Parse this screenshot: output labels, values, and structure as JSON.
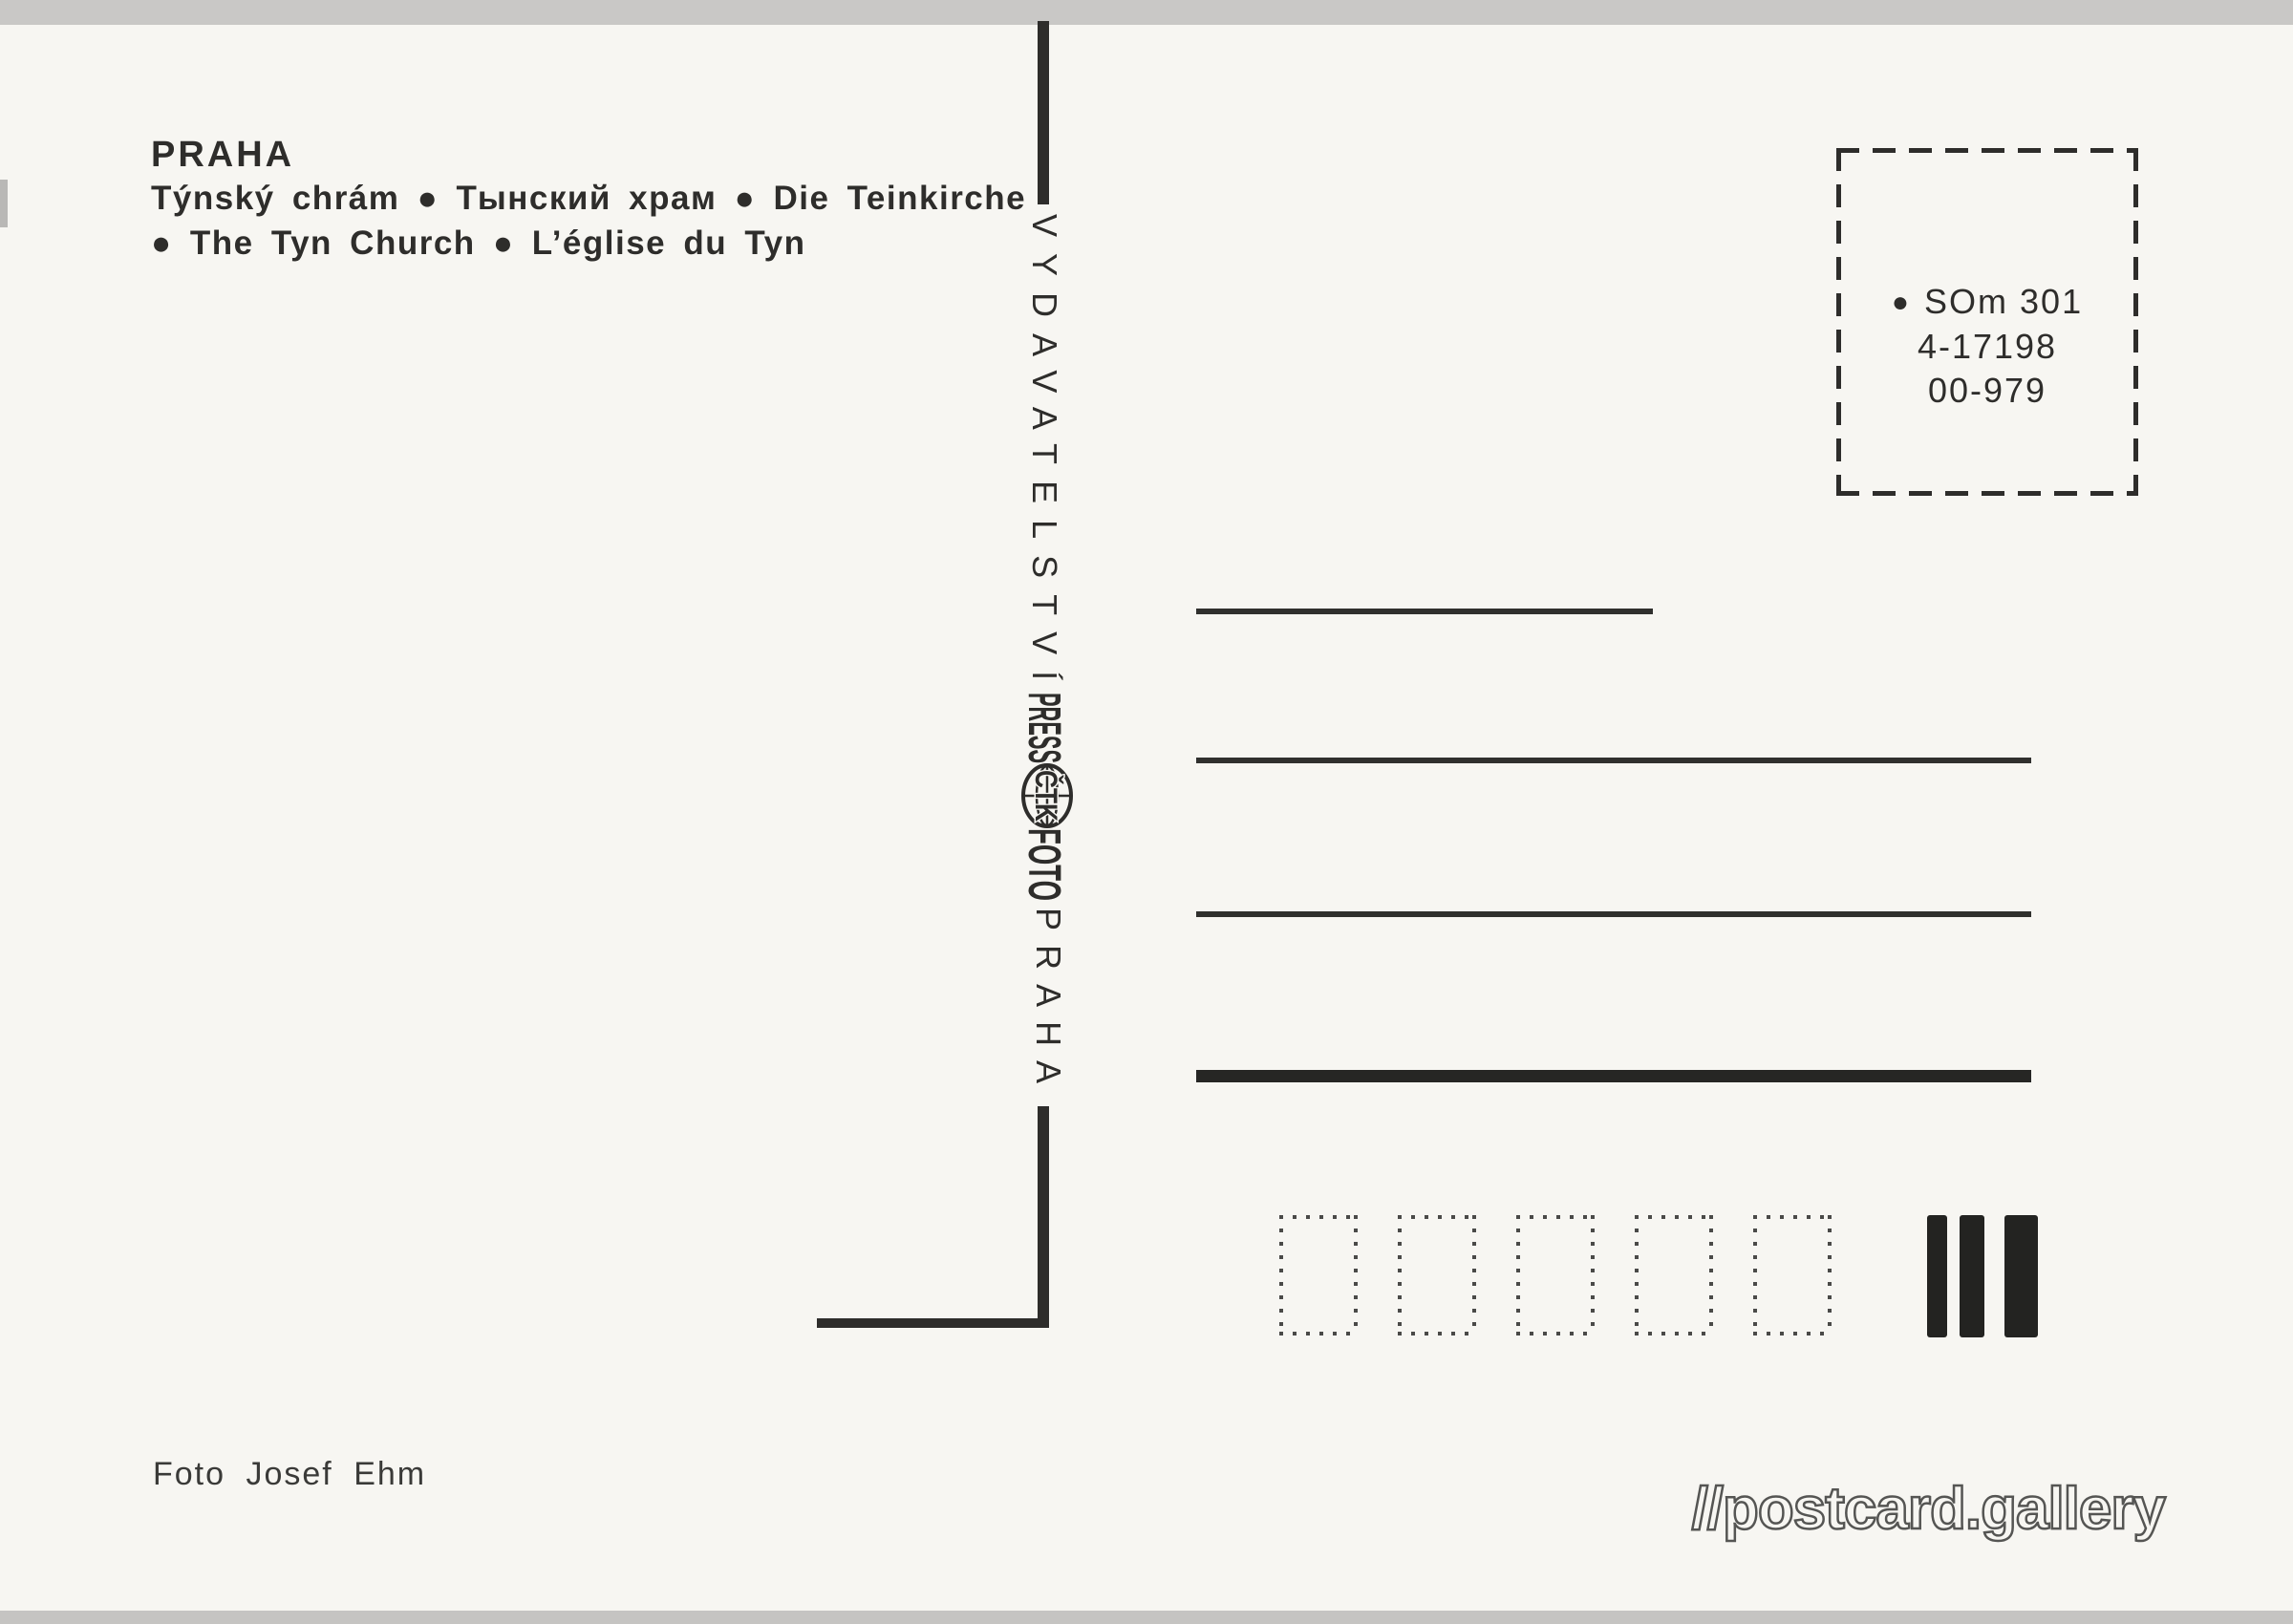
{
  "postcard": {
    "title": "PRAHA",
    "caption_cs_ru_de": "Týnský chrám ● Тынский храм ● Die Teinkirche",
    "caption_en_fr": "● The Tyn Church ● L’église du Tyn",
    "photo_credit": "Foto Josef Ehm"
  },
  "publisher_strip": {
    "name_vertical": "VYDAVATELSTVÍ",
    "logo": {
      "press": "PRESS",
      "agency": "ČTK",
      "foto": "FOTO"
    },
    "city_vertical": "PRAHA"
  },
  "stamp_box": {
    "bullet": "●",
    "lines": [
      "SOm 301",
      "4-17198",
      "00-979"
    ]
  },
  "watermark": "//postcard.gallery",
  "colors": {
    "ink": "#2e2d2b",
    "paper": "#f7f6f2",
    "scanner_edge": "#c9c8c6"
  }
}
